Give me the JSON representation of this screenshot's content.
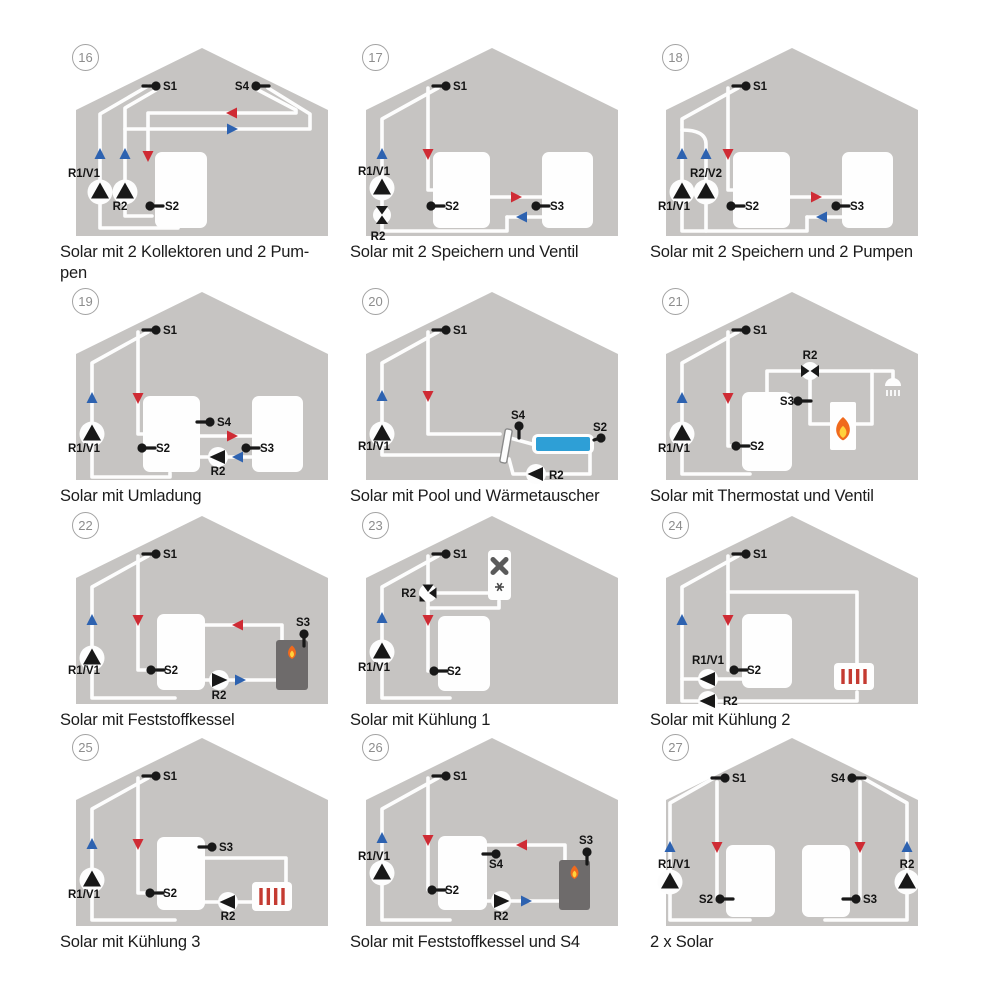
{
  "colors": {
    "house": "#c6c4c2",
    "pipe": "#fdfdfd",
    "tank": "#fefefe",
    "hot": "#cf2b34",
    "cold": "#2d62b0",
    "black": "#181818",
    "pool": "#2e9fd6",
    "boiler_dark": "#6e6b6b",
    "boiler_white": "#fefefe",
    "radiator_bar": "#c43a31",
    "flame_outer": "#f06a1d",
    "flame_inner": "#ffd23d",
    "fan": "#5a5a5a",
    "hx_stroke": "#8a8a8a"
  },
  "cells": [
    {
      "number": "16",
      "caption": "Solar mit 2 Kollektoren und 2 Pum-\npen",
      "labels": {
        "s1": "S1",
        "s4": "S4",
        "s2": "S2",
        "r1": "R1/V1",
        "r2": "R2"
      }
    },
    {
      "number": "17",
      "caption": "Solar mit 2 Speichern und Ventil",
      "labels": {
        "s1": "S1",
        "s2": "S2",
        "s3": "S3",
        "r1": "R1/V1",
        "r2": "R2"
      }
    },
    {
      "number": "18",
      "caption": "Solar mit 2 Speichern und 2 Pumpen",
      "labels": {
        "s1": "S1",
        "s2": "S2",
        "s3": "S3",
        "r1": "R1/V1",
        "r2v2": "R2/V2"
      }
    },
    {
      "number": "19",
      "caption": "Solar mit Umladung",
      "labels": {
        "s1": "S1",
        "s2": "S2",
        "s3": "S3",
        "s4": "S4",
        "r1": "R1/V1",
        "r2": "R2"
      }
    },
    {
      "number": "20",
      "caption": "Solar mit Pool und Wärmetauscher",
      "labels": {
        "s1": "S1",
        "s2": "S2",
        "s4": "S4",
        "r1": "R1/V1",
        "r2": "R2"
      }
    },
    {
      "number": "21",
      "caption": "Solar mit Thermostat und Ventil",
      "labels": {
        "s1": "S1",
        "s2": "S2",
        "s3": "S3",
        "r1": "R1/V1",
        "r2": "R2"
      }
    },
    {
      "number": "22",
      "caption": "Solar mit Feststoffkessel",
      "labels": {
        "s1": "S1",
        "s2": "S2",
        "s3": "S3",
        "r1": "R1/V1",
        "r2": "R2"
      }
    },
    {
      "number": "23",
      "caption": "Solar mit Kühlung 1",
      "labels": {
        "s1": "S1",
        "s2": "S2",
        "r1": "R1/V1",
        "r2": "R2"
      }
    },
    {
      "number": "24",
      "caption": "Solar mit Kühlung 2",
      "labels": {
        "s1": "S1",
        "s2": "S2",
        "r1": "R1/V1",
        "r2": "R2"
      }
    },
    {
      "number": "25",
      "caption": "Solar mit Kühlung 3",
      "labels": {
        "s1": "S1",
        "s2": "S2",
        "s3": "S3",
        "r1": "R1/V1",
        "r2": "R2"
      }
    },
    {
      "number": "26",
      "caption": "Solar mit Feststoffkessel und S4",
      "labels": {
        "s1": "S1",
        "s2": "S2",
        "s3": "S3",
        "s4": "S4",
        "r1": "R1/V1",
        "r2": "R2"
      }
    },
    {
      "number": "27",
      "caption": "2 x Solar",
      "labels": {
        "s1": "S1",
        "s2": "S2",
        "s3": "S3",
        "s4": "S4",
        "r1": "R1/V1",
        "r2": "R2"
      }
    }
  ]
}
